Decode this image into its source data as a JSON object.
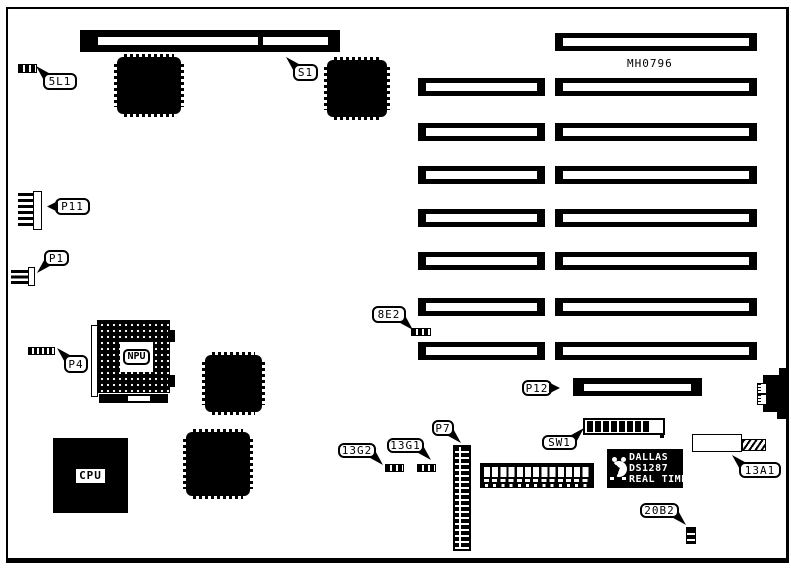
{
  "board": {
    "part_number": "MH0796",
    "callouts": {
      "l5l1": "5L1",
      "s1": "S1",
      "p11": "P11",
      "p1": "P1",
      "p4": "P4",
      "e8e2": "8E2",
      "p12": "P12",
      "sw1": "SW1",
      "g13g2": "13G2",
      "g13g1": "13G1",
      "p7": "P7",
      "a13a1": "13A1",
      "b20b2": "20B2"
    },
    "chips": {
      "cpu": "CPU",
      "npu": "NPU"
    },
    "rtc": {
      "brand": "DALLAS",
      "model": "DS1287",
      "type": "REAL TIME"
    },
    "colors": {
      "ink": "#000000",
      "paper": "#ffffff"
    }
  }
}
